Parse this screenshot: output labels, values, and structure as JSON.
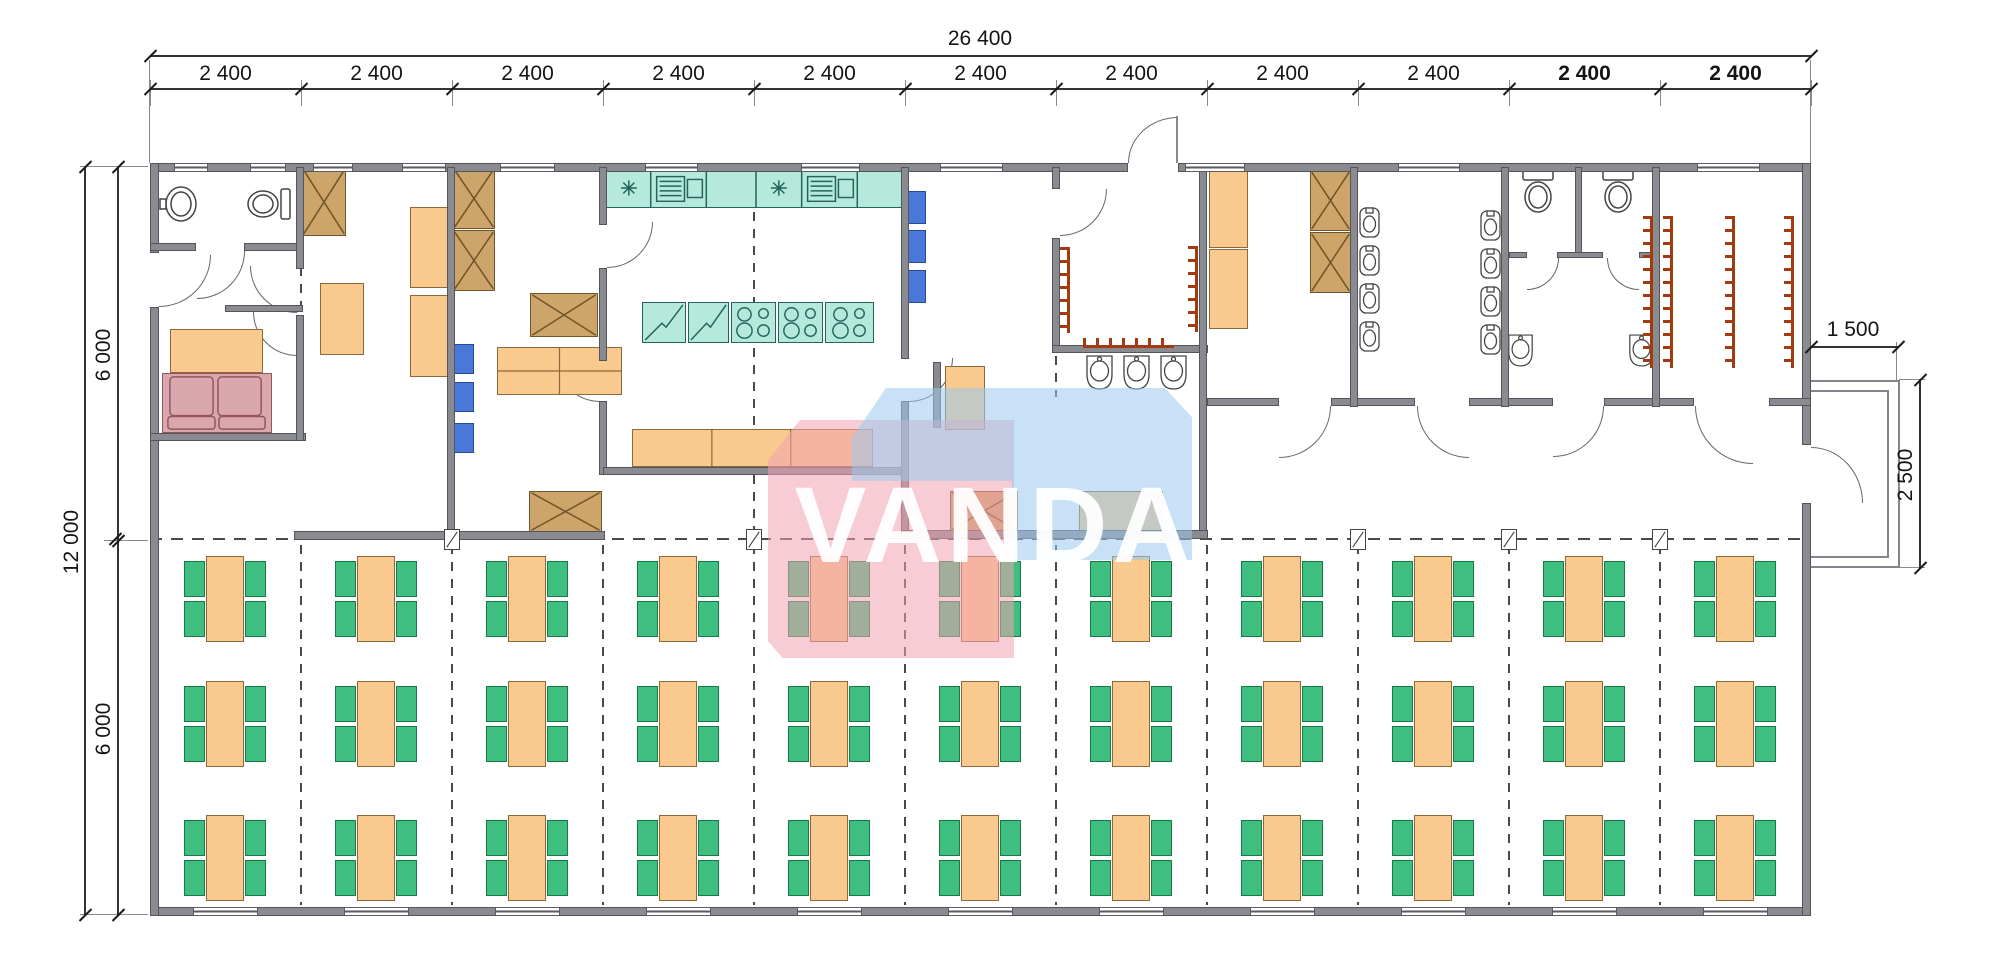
{
  "watermark": {
    "text": "VANDA",
    "pink_color": "rgba(243,163,176,0.55)",
    "blue_color": "rgba(155,200,238,0.55)"
  },
  "dimensions": {
    "total_width_label": "26 400",
    "module_labels": [
      "2 400",
      "2 400",
      "2 400",
      "2 400",
      "2 400",
      "2 400",
      "2 400",
      "2 400",
      "2 400",
      "2 400",
      "2 400"
    ],
    "bold_module_indexes": [
      9,
      10
    ],
    "left_total": "12 000",
    "left_halves": [
      "6 000",
      "6 000"
    ],
    "porch_width": "1 500",
    "porch_depth": "2 500"
  },
  "colors": {
    "wall": "#8a8a91",
    "furniture_orange": "#f9c98e",
    "chair_green": "#3fbf7f",
    "kitchen_teal": "#b5e9db",
    "cabinet_tan": "#cda56a",
    "shelf_blue": "#4a78d8",
    "sofa_pink": "#dba7ae",
    "coat_rack_red": "#a33b12"
  },
  "plan": {
    "walls": [
      [
        150,
        163,
        978,
        9
      ],
      [
        1178,
        163,
        633,
        9
      ],
      [
        150,
        907,
        1661,
        9
      ],
      [
        150,
        163,
        9,
        90
      ],
      [
        150,
        307,
        9,
        609
      ],
      [
        1802,
        163,
        9,
        282
      ],
      [
        1802,
        503,
        9,
        413
      ],
      [
        150,
        243,
        46,
        8
      ],
      [
        244,
        243,
        57,
        8
      ],
      [
        225,
        305,
        78,
        7
      ],
      [
        150,
        433,
        156,
        8
      ],
      [
        296,
        167,
        8,
        102
      ],
      [
        296,
        315,
        8,
        126
      ],
      [
        447,
        167,
        8,
        372
      ],
      [
        294,
        531,
        311,
        9
      ],
      [
        599,
        167,
        8,
        58
      ],
      [
        599,
        268,
        8,
        93
      ],
      [
        599,
        401,
        8,
        74
      ],
      [
        603,
        467,
        303,
        8
      ],
      [
        901,
        167,
        8,
        192
      ],
      [
        901,
        401,
        8,
        137
      ],
      [
        933,
        362,
        8,
        66
      ],
      [
        1052,
        167,
        8,
        22
      ],
      [
        1052,
        238,
        8,
        115
      ],
      [
        1052,
        345,
        156,
        8
      ],
      [
        1199,
        167,
        8,
        372
      ],
      [
        901,
        530,
        307,
        9
      ],
      [
        1207,
        398,
        72,
        8
      ],
      [
        1331,
        398,
        84,
        8
      ],
      [
        1469,
        398,
        84,
        8
      ],
      [
        1604,
        398,
        90,
        8
      ],
      [
        1769,
        398,
        42,
        8
      ],
      [
        1350,
        167,
        8,
        240
      ],
      [
        1501,
        167,
        8,
        240
      ],
      [
        1652,
        167,
        8,
        240
      ],
      [
        1575,
        167,
        7,
        88
      ],
      [
        1509,
        252,
        18,
        6
      ],
      [
        1557,
        252,
        46,
        6
      ],
      [
        1639,
        252,
        14,
        6
      ]
    ],
    "windows_top": [
      [
        174,
        34
      ],
      [
        250,
        36
      ],
      [
        313,
        40
      ],
      [
        402,
        44
      ],
      [
        500,
        55
      ],
      [
        645,
        53
      ],
      [
        801,
        59
      ],
      [
        940,
        63
      ],
      [
        1185,
        60
      ],
      [
        1398,
        62
      ],
      [
        1697,
        63
      ]
    ],
    "windows_bottom": [
      [
        193,
        65
      ],
      [
        344,
        65
      ],
      [
        495,
        65
      ],
      [
        646,
        65
      ],
      [
        797,
        65
      ],
      [
        948,
        65
      ],
      [
        1099,
        65
      ],
      [
        1250,
        65
      ],
      [
        1401,
        65
      ],
      [
        1552,
        65
      ],
      [
        1703,
        65
      ]
    ],
    "doors": [
      [
        197,
        251,
        48,
        48,
        "br"
      ],
      [
        159,
        255,
        52,
        52,
        "br"
      ],
      [
        250,
        266,
        47,
        47,
        "bl"
      ],
      [
        253,
        312,
        44,
        44,
        "bl"
      ],
      [
        607,
        222,
        46,
        46,
        "br"
      ],
      [
        556,
        358,
        44,
        44,
        "bl"
      ],
      [
        909,
        358,
        44,
        44,
        "br"
      ],
      [
        1060,
        189,
        47,
        47,
        "br"
      ],
      [
        1128,
        117,
        50,
        46,
        "tl"
      ],
      [
        1279,
        406,
        52,
        52,
        "br"
      ],
      [
        1417,
        406,
        52,
        52,
        "bl"
      ],
      [
        1553,
        406,
        51,
        51,
        "br"
      ],
      [
        1527,
        258,
        32,
        32,
        "br"
      ],
      [
        1607,
        258,
        32,
        32,
        "bl"
      ],
      [
        1695,
        406,
        58,
        58,
        "bl"
      ],
      [
        1811,
        447,
        52,
        56,
        "tr"
      ]
    ],
    "dash_v": [
      [
        301,
        545,
        905
      ],
      [
        452,
        545,
        905
      ],
      [
        603,
        545,
        905
      ],
      [
        754,
        545,
        905
      ],
      [
        905,
        545,
        905
      ],
      [
        1056,
        545,
        905
      ],
      [
        1207,
        545,
        905
      ],
      [
        1358,
        545,
        905
      ],
      [
        1509,
        545,
        905
      ],
      [
        1660,
        545,
        905
      ],
      [
        754,
        212,
        462
      ],
      [
        754,
        475,
        538
      ],
      [
        1056,
        356,
        397
      ],
      [
        301,
        250,
        314
      ]
    ],
    "dash_h": [
      [
        150,
        539,
        1661
      ]
    ],
    "squares": [
      452,
      754,
      1358,
      1509,
      1660
    ],
    "furniture": [
      [
        "sink",
        158,
        183,
        42,
        42
      ],
      [
        "wc",
        243,
        186,
        50,
        36
      ],
      [
        "rect-o",
        170,
        329,
        93,
        44
      ],
      [
        "sofa",
        162,
        373,
        110,
        60
      ],
      [
        "xcab",
        302,
        168,
        44,
        68
      ],
      [
        "rect-o",
        320,
        283,
        44,
        72
      ],
      [
        "rect-o",
        410,
        207,
        39,
        81
      ],
      [
        "rect-o",
        410,
        295,
        39,
        82
      ],
      [
        "xcab",
        453,
        168,
        42,
        61
      ],
      [
        "xcab",
        453,
        230,
        42,
        61
      ],
      [
        "blue",
        452,
        344,
        22,
        30
      ],
      [
        "blue",
        452,
        382,
        22,
        30
      ],
      [
        "blue",
        452,
        423,
        22,
        30
      ],
      [
        "xcab",
        530,
        293,
        68,
        44
      ],
      [
        "counter2",
        497,
        347,
        125,
        48
      ],
      [
        "xcab",
        529,
        491,
        73,
        41
      ],
      [
        "kcounter",
        606,
        168,
        296,
        40
      ],
      [
        "fridge",
        642,
        302,
        44,
        41
      ],
      [
        "fridge",
        688,
        302,
        41,
        41
      ],
      [
        "stove",
        731,
        302,
        45,
        41
      ],
      [
        "stove",
        778,
        302,
        45,
        41
      ],
      [
        "stove",
        825,
        302,
        49,
        41
      ],
      [
        "counter3",
        632,
        429,
        241,
        38
      ],
      [
        "blue",
        906,
        191,
        20,
        33
      ],
      [
        "blue",
        906,
        230,
        20,
        33
      ],
      [
        "blue",
        906,
        270,
        20,
        33
      ],
      [
        "rect-o",
        945,
        366,
        40,
        64
      ],
      [
        "xcab",
        950,
        491,
        68,
        40
      ],
      [
        "rect-o",
        1079,
        491,
        84,
        40
      ],
      [
        "hooksv",
        1060,
        247,
        10,
        86
      ],
      [
        "hooksv",
        1188,
        246,
        10,
        86
      ],
      [
        "hooksh",
        1083,
        338,
        91,
        10
      ],
      [
        "basin",
        1084,
        354,
        31,
        37
      ],
      [
        "basin",
        1121,
        354,
        31,
        37
      ],
      [
        "basin",
        1158,
        354,
        31,
        37
      ],
      [
        "rect-o",
        1209,
        168,
        39,
        80
      ],
      [
        "rect-o",
        1209,
        249,
        39,
        80
      ],
      [
        "xcab",
        1310,
        170,
        41,
        61
      ],
      [
        "xcab",
        1310,
        232,
        41,
        61
      ],
      [
        "urinal",
        1359,
        207,
        21,
        31
      ],
      [
        "urinal",
        1359,
        245,
        21,
        31
      ],
      [
        "urinal",
        1359,
        283,
        21,
        31
      ],
      [
        "urinal",
        1359,
        321,
        21,
        31
      ],
      [
        "urinal",
        1480,
        210,
        21,
        31
      ],
      [
        "urinal",
        1480,
        248,
        21,
        31
      ],
      [
        "urinal",
        1480,
        286,
        21,
        31
      ],
      [
        "urinal",
        1480,
        324,
        21,
        31
      ],
      [
        "wct",
        1517,
        168,
        42,
        47
      ],
      [
        "wct",
        1597,
        168,
        42,
        47
      ],
      [
        "basin",
        1506,
        333,
        29,
        35
      ],
      [
        "basin",
        1627,
        333,
        29,
        35
      ],
      [
        "hooksv",
        1643,
        216,
        10,
        152
      ],
      [
        "hooksv",
        1663,
        216,
        10,
        152
      ],
      [
        "hooksv",
        1725,
        216,
        10,
        152
      ],
      [
        "hooksv",
        1784,
        216,
        10,
        152
      ]
    ],
    "tables": {
      "col_centers": [
        225,
        376,
        527,
        678,
        829,
        980,
        1131,
        1282,
        1433,
        1584,
        1735
      ],
      "row_tops": [
        556,
        681,
        815
      ],
      "table_w": 38,
      "table_h": 86,
      "chair_w": 21,
      "chair_h": 36
    },
    "porch": {
      "outer": [
        1811,
        380,
        89,
        188
      ],
      "inner": [
        1811,
        390,
        78,
        168
      ]
    },
    "dim_lines": [
      [
        150,
        55,
        1661,
        2
      ],
      [
        150,
        88,
        1661,
        2
      ],
      [
        84,
        167,
        2,
        748
      ],
      [
        117,
        167,
        2,
        748
      ],
      [
        1811,
        346,
        87,
        2
      ],
      [
        1919,
        380,
        2,
        188
      ]
    ],
    "ext_lines": [
      [
        149,
        60,
        1,
        103
      ],
      [
        1810,
        60,
        1,
        103
      ],
      [
        80,
        166,
        68,
        1
      ],
      [
        104,
        540,
        44,
        1
      ],
      [
        80,
        914,
        68,
        1
      ],
      [
        1896,
        342,
        1,
        40
      ],
      [
        1899,
        379,
        26,
        1
      ],
      [
        1899,
        567,
        26,
        1
      ],
      [
        1176,
        116,
        2,
        47
      ]
    ],
    "module_boundaries": [
      150,
      301,
      452,
      603,
      754,
      905,
      1056,
      1207,
      1358,
      1509,
      1660,
      1811
    ],
    "ticks": [
      [
        150,
        56
      ],
      [
        1811,
        56
      ],
      [
        150,
        89
      ],
      [
        301,
        89
      ],
      [
        452,
        89
      ],
      [
        603,
        89
      ],
      [
        754,
        89
      ],
      [
        905,
        89
      ],
      [
        1056,
        89
      ],
      [
        1207,
        89
      ],
      [
        1358,
        89
      ],
      [
        1509,
        89
      ],
      [
        1660,
        89
      ],
      [
        1811,
        89
      ],
      [
        85,
        167
      ],
      [
        85,
        915
      ],
      [
        118,
        167
      ],
      [
        118,
        541
      ],
      [
        118,
        915
      ],
      [
        1811,
        347
      ],
      [
        1898,
        347
      ],
      [
        1920,
        380
      ],
      [
        1920,
        568
      ],
      [
        115,
        539
      ]
    ]
  }
}
